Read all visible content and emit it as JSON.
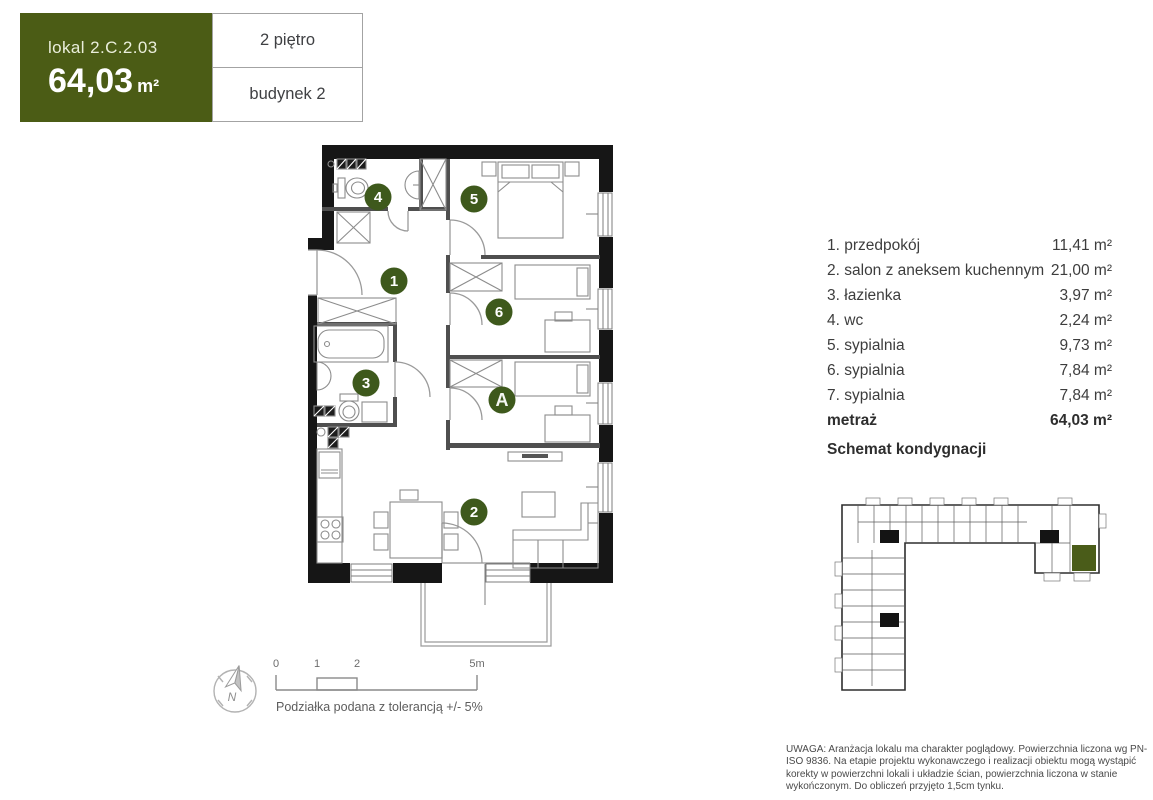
{
  "header": {
    "unit_label": "lokal 2.C.2.03",
    "area_value": "64,03",
    "area_unit": "m²",
    "floor_label": "2 piętro",
    "building_label": "budynek 2"
  },
  "legend": {
    "rows": [
      {
        "num": "1.",
        "name": "przedpokój",
        "area": "11,41 m²"
      },
      {
        "num": "2.",
        "name": "salon z aneksem kuchennym",
        "area": "21,00 m²"
      },
      {
        "num": "3.",
        "name": "łazienka",
        "area": "3,97 m²"
      },
      {
        "num": "4.",
        "name": "wc",
        "area": "2,24 m²"
      },
      {
        "num": "5.",
        "name": "sypialnia",
        "area": "9,73 m²"
      },
      {
        "num": "6.",
        "name": "sypialnia",
        "area": "7,84 m²"
      },
      {
        "num": "7.",
        "name": "sypialnia",
        "area": "7,84 m²"
      }
    ],
    "total_label": "metraż",
    "total_area": "64,03 m²",
    "schematic_title": "Schemat kondygnacji"
  },
  "plan": {
    "badges": [
      {
        "label": "1"
      },
      {
        "label": "2"
      },
      {
        "label": "3"
      },
      {
        "label": "4"
      },
      {
        "label": "5"
      },
      {
        "label": "6"
      },
      {
        "label": "A"
      }
    ]
  },
  "scalebar": {
    "labels": [
      "0",
      "1",
      "2",
      "5m"
    ],
    "caption": "Podziałka podana z tolerancją +/- 5%"
  },
  "compass": {
    "label": "N"
  },
  "disclaimer": "UWAGA: Aranżacja lokalu ma charakter poglądowy. Powierzchnia liczona wg PN-ISO 9836. Na etapie projektu wykonawczego i realizacji obiektu mogą wystąpić korekty w powierzchni lokali i układzie ścian, powierzchnia liczona w stanie wykończonym. Do obliczeń przyjęto 1,5cm tynku.",
  "colors": {
    "brand_green": "#4b5c15",
    "badge_green": "#3e591c",
    "wall_black": "#161616",
    "highlight_green": "#4a5c19"
  }
}
